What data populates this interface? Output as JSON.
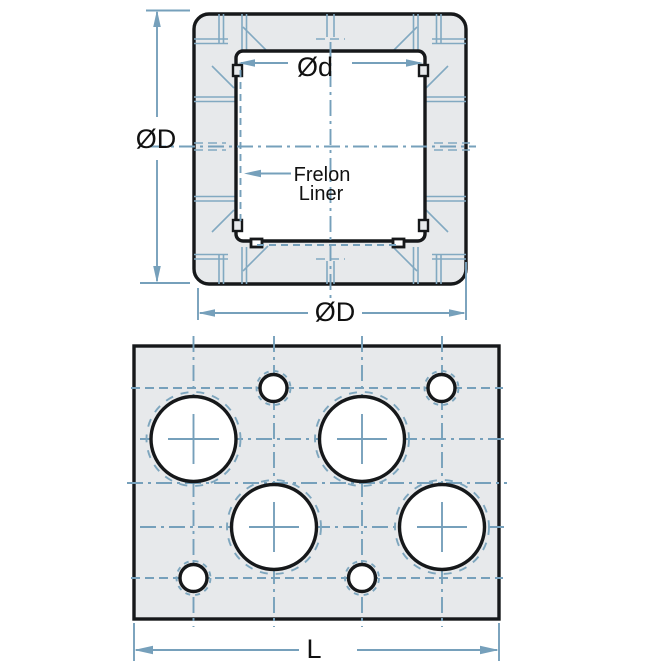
{
  "drawing": {
    "views": {
      "cross_section": {
        "labels": {
          "outer_dim_left": "ØD",
          "bore_dim": "Ød",
          "outer_dim_bottom": "ØD",
          "liner_line1": "Frelon",
          "liner_line2": "Liner"
        }
      },
      "front": {
        "labels": {
          "length_dim": "L"
        },
        "large_holes": 4,
        "small_holes": 4
      }
    },
    "colors": {
      "body_fill": "#e7e9eb",
      "outline": "#16181a",
      "annotation_blue": "#76a0bb"
    }
  }
}
